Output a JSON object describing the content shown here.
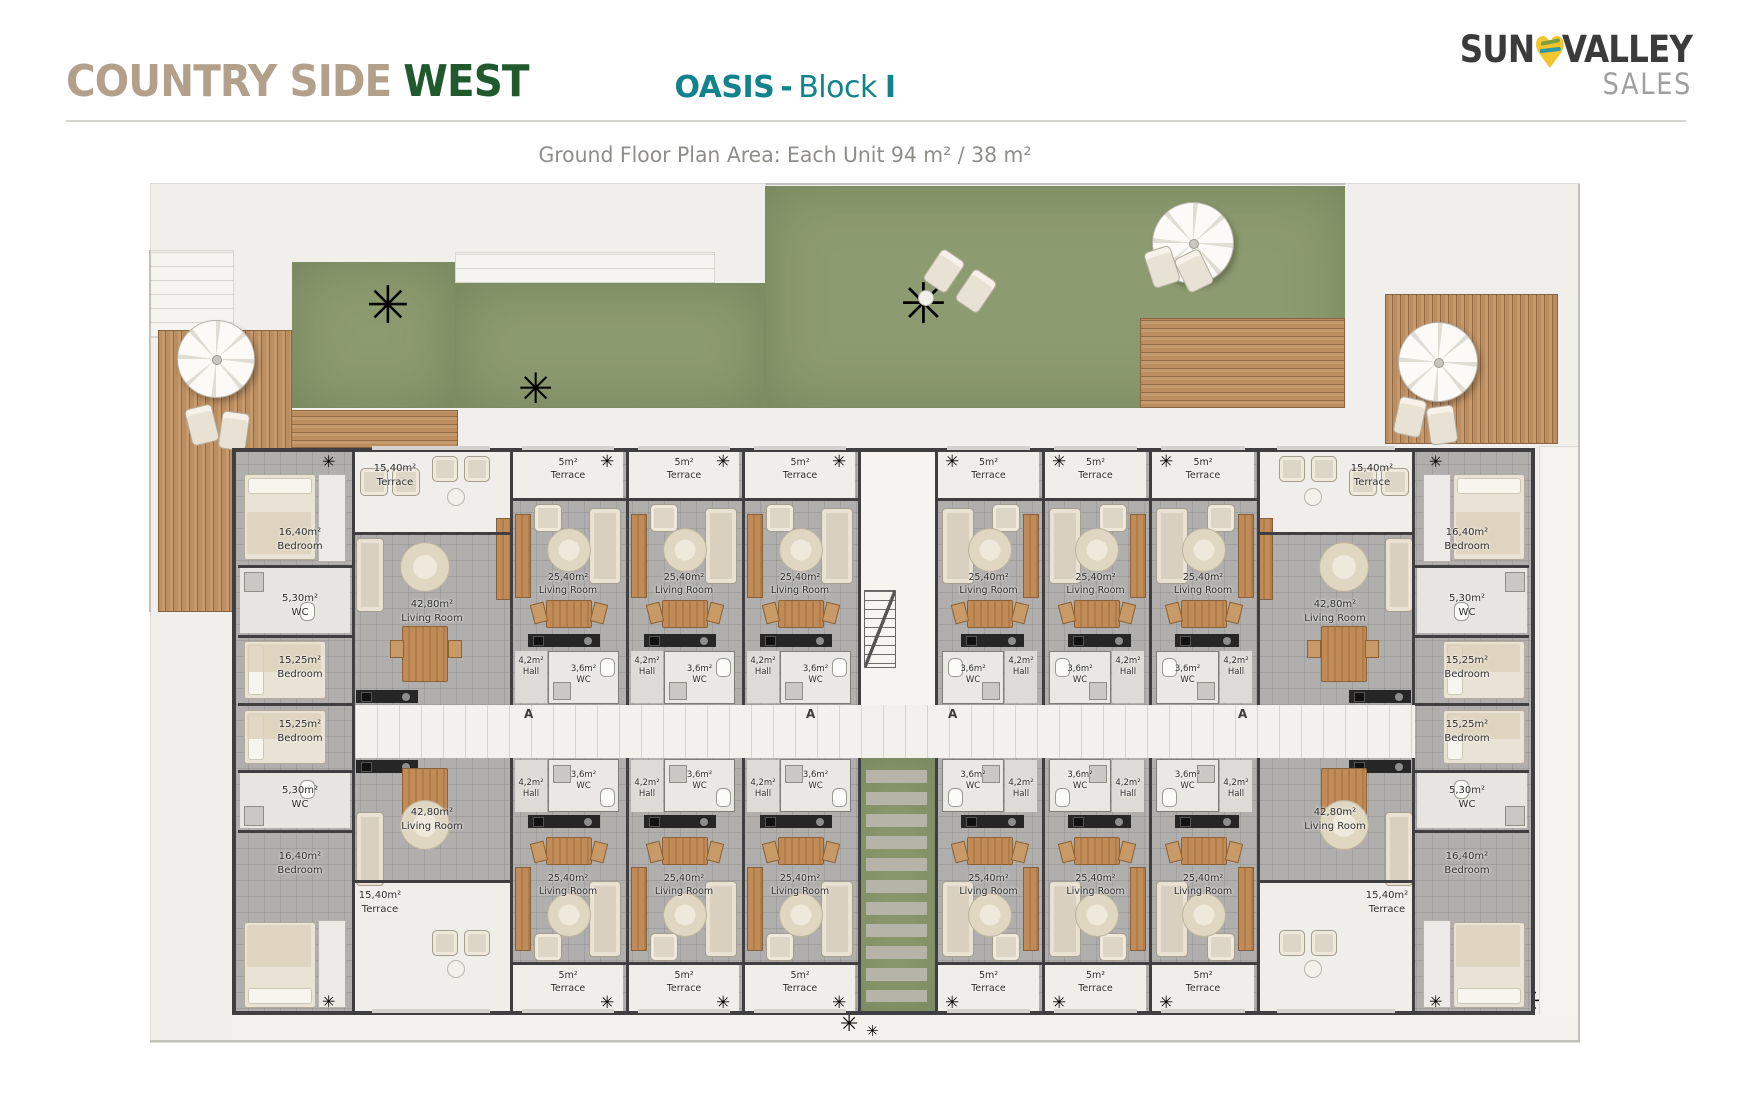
{
  "header": {
    "brand": {
      "part1": "COUNTRY SIDE",
      "part2": "WEST"
    },
    "title": {
      "project": "OASIS",
      "separator": "-",
      "block_word": "Block",
      "block_letter": "I"
    },
    "subtitle": "Ground Floor Plan Area: Each Unit 94 m² / 38 m²",
    "logo": {
      "word1": "SUN",
      "word2": "VALLEY",
      "word3": "SALES"
    }
  },
  "plan": {
    "section_marker": "A",
    "rooms": {
      "end_terrace": {
        "area": "15,40m²",
        "name": "Terrace"
      },
      "bedroom_large": {
        "area": "16,40m²",
        "name": "Bedroom"
      },
      "wc_end": {
        "area": "5,30m²",
        "name": "WC"
      },
      "bedroom_small": {
        "area": "15,25m²",
        "name": "Bedroom"
      },
      "living_end": {
        "area": "42,80m²",
        "name": "Living Room"
      },
      "terrace_studio": {
        "area": "5m²",
        "name": "Terrace"
      },
      "living_studio": {
        "area": "25,40m²",
        "name": "Living Room"
      },
      "hall_studio": {
        "area": "4,2m²",
        "name": "Hall"
      },
      "wc_studio": {
        "area": "3,6m²",
        "name": "WC"
      }
    }
  },
  "colors": {
    "brand_tan": "#b3a08a",
    "brand_green": "#20592e",
    "title_teal": "#12838d",
    "subtitle_gray": "#8f8d89",
    "logo_dark": "#3b3b3b",
    "logo_gray": "#a19f9d",
    "logo_yellow": "#f3c62f",
    "grass": "#8d9c70",
    "wood": "#b5885e",
    "wall": "#3f3f42",
    "site": "#f0efec",
    "floor": "#b0afad",
    "terrace_floor": "#efeeeb",
    "label_ink": "#2c2c2c"
  }
}
